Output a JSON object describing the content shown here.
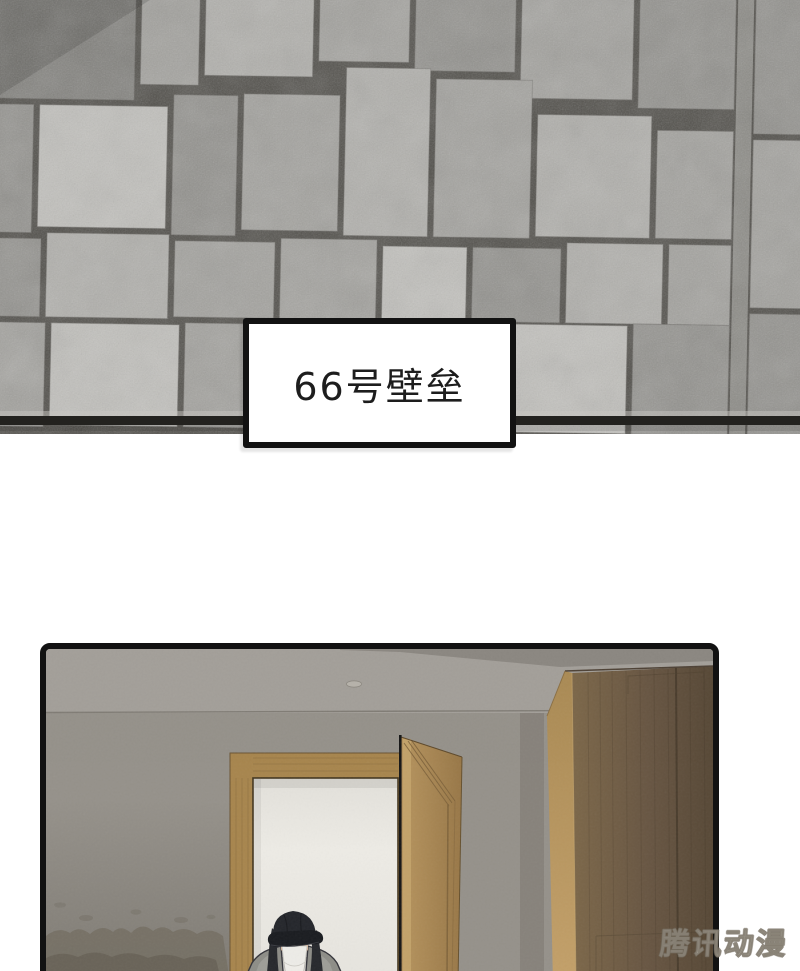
{
  "caption": {
    "text": "66号壁垒"
  },
  "watermark": {
    "text": "腾讯动漫"
  },
  "colors": {
    "panel_border": "#121212",
    "caption_border": "#121212",
    "caption_bg": "#ffffff",
    "caption_text": "#1d1d1d",
    "stone_seam": "#504e49",
    "wall": "#95918a",
    "ceiling": "#a39f99",
    "doorway_light": "#eae8e2",
    "wood_frame": "#a7854d",
    "door_wood": "#ad8b54",
    "wardrobe_side": "#b79560",
    "wardrobe_front": "#6b5840",
    "cap": "#24262b",
    "hair": "#26282c",
    "skin": "#d9b498",
    "mask": "#edece7",
    "jacket": "#8d8d87",
    "shirt": "#efede8"
  }
}
